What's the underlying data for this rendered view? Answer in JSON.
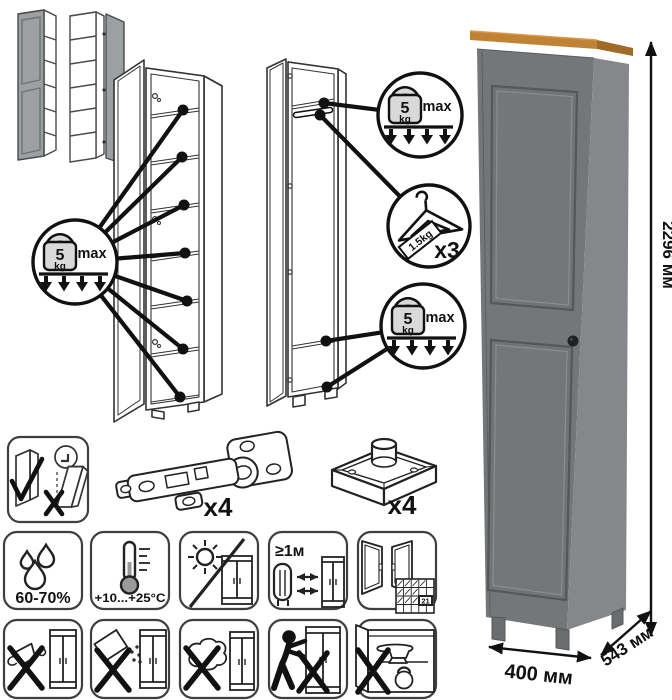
{
  "diagram": {
    "weight_limit": {
      "value": "5",
      "unit": "kg",
      "max": "max"
    },
    "hanger_limit": {
      "label": "1.5kg",
      "count": "x3"
    },
    "hinge_count": "x4",
    "foot_count": "x4"
  },
  "care": {
    "humidity": "60-70%",
    "temperature": "+10...+25°C",
    "min_distance": "≥1м",
    "acclimatization_day": "21"
  },
  "dimensions": {
    "height": "2296 мм",
    "width": "400 мм",
    "depth": "543 мм"
  },
  "colors": {
    "cabinet_front": "#747779",
    "cabinet_side": "#85878a",
    "top_trim_wood": "#c08336",
    "line_art": "#1a1a1a",
    "weight_fill": "#d9d9d9"
  },
  "icons": {
    "assembly": [
      "wall-anchor-warning-icon",
      "hinge-hardware-icon",
      "adjustable-foot-icon"
    ],
    "placement": [
      "humidity-icon",
      "temperature-icon",
      "no-direct-sunlight-icon",
      "heater-distance-icon",
      "ventilation-acclimatization-icon"
    ],
    "care": [
      "no-liquids-icon",
      "no-abrasive-powder-icon",
      "no-scouring-icon",
      "no-dragging-icon",
      "no-overloading-icon"
    ],
    "callouts": [
      "shelf-load-limit-badge",
      "hanger-load-limit-badge"
    ]
  }
}
